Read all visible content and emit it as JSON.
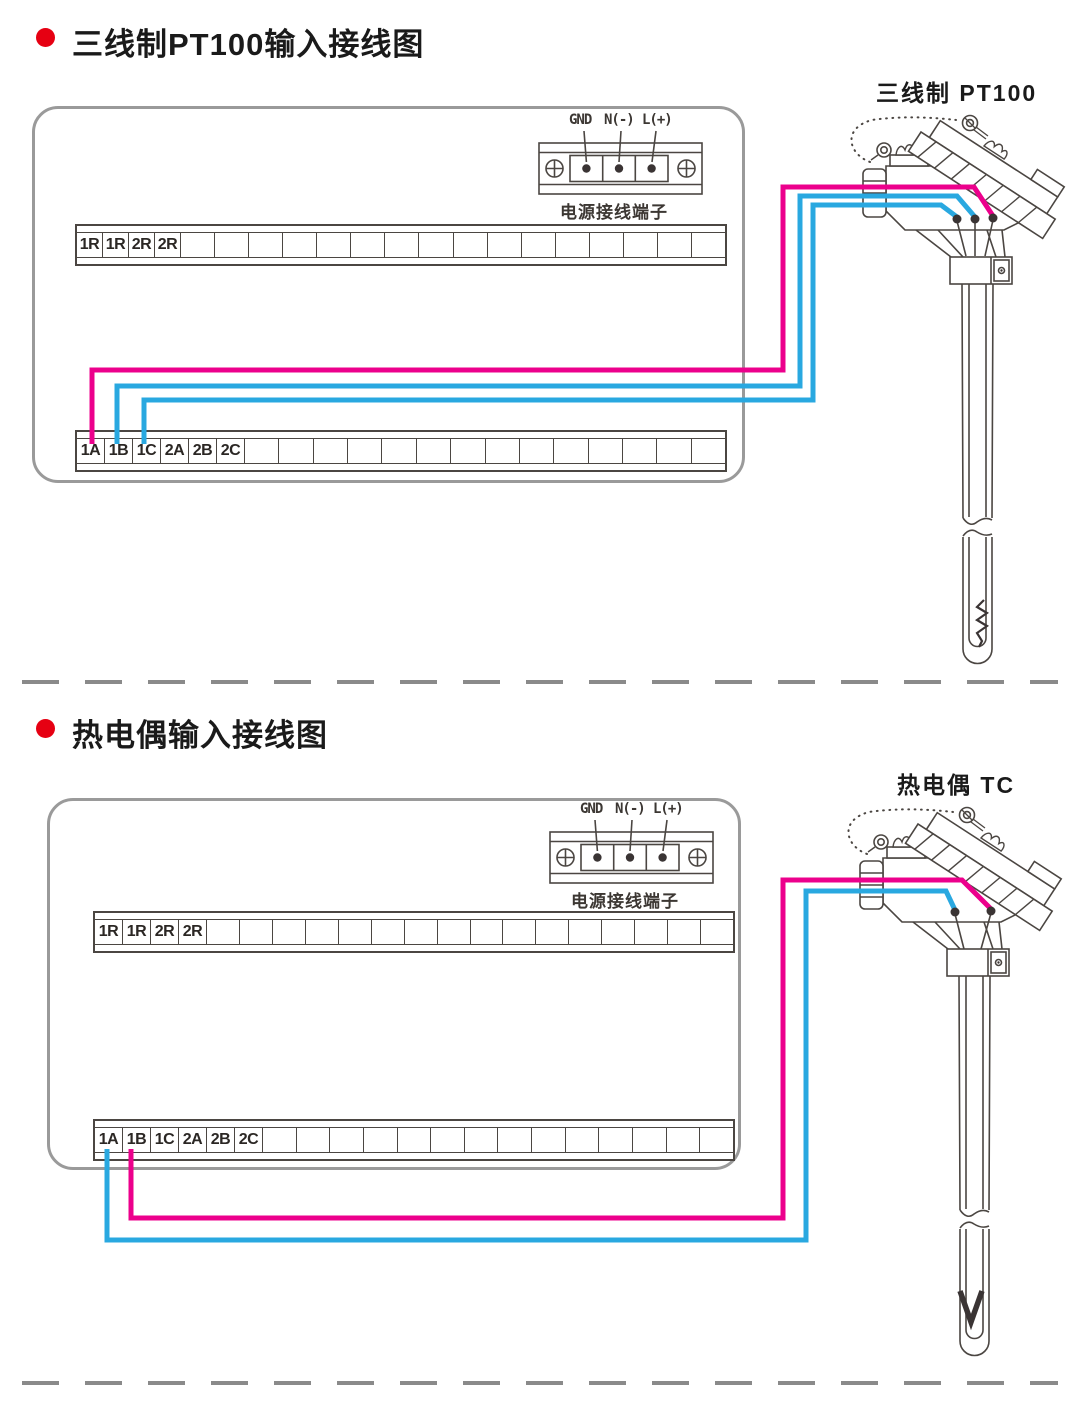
{
  "colors": {
    "wire_pink": "#EC008C",
    "wire_blue": "#29A8E0",
    "bullet_red": "#E60012",
    "line_art": "#4B4642",
    "panel_border": "#9A9A9A",
    "divider_gray": "#8A8A8A",
    "terminal_dot": "#3A3434"
  },
  "section1": {
    "title": "三线制PT100输入接线图",
    "sensor_label": "三线制 PT100",
    "power": {
      "labels": [
        "GND",
        "N(-)",
        "L(+)"
      ],
      "caption": "电源接线端子"
    },
    "top_strip": {
      "labels": [
        "1R",
        "1R",
        "2R",
        "2R"
      ],
      "empty_cells": 16,
      "label_cell_width": 25
    },
    "bottom_strip": {
      "labels": [
        "1A",
        "1B",
        "1C",
        "2A",
        "2B",
        "2C"
      ],
      "empty_cells": 14,
      "label_cell_width": 27
    }
  },
  "section2": {
    "title": "热电偶输入接线图",
    "sensor_label": "热电偶 TC",
    "power": {
      "labels": [
        "GND",
        "N(-)",
        "L(+)"
      ],
      "caption": "电源接线端子"
    },
    "top_strip": {
      "labels": [
        "1R",
        "1R",
        "2R",
        "2R"
      ],
      "empty_cells": 16,
      "label_cell_width": 27
    },
    "bottom_strip": {
      "labels": [
        "1A",
        "1B",
        "1C",
        "2A",
        "2B",
        "2C"
      ],
      "empty_cells": 14,
      "label_cell_width": 27
    }
  }
}
